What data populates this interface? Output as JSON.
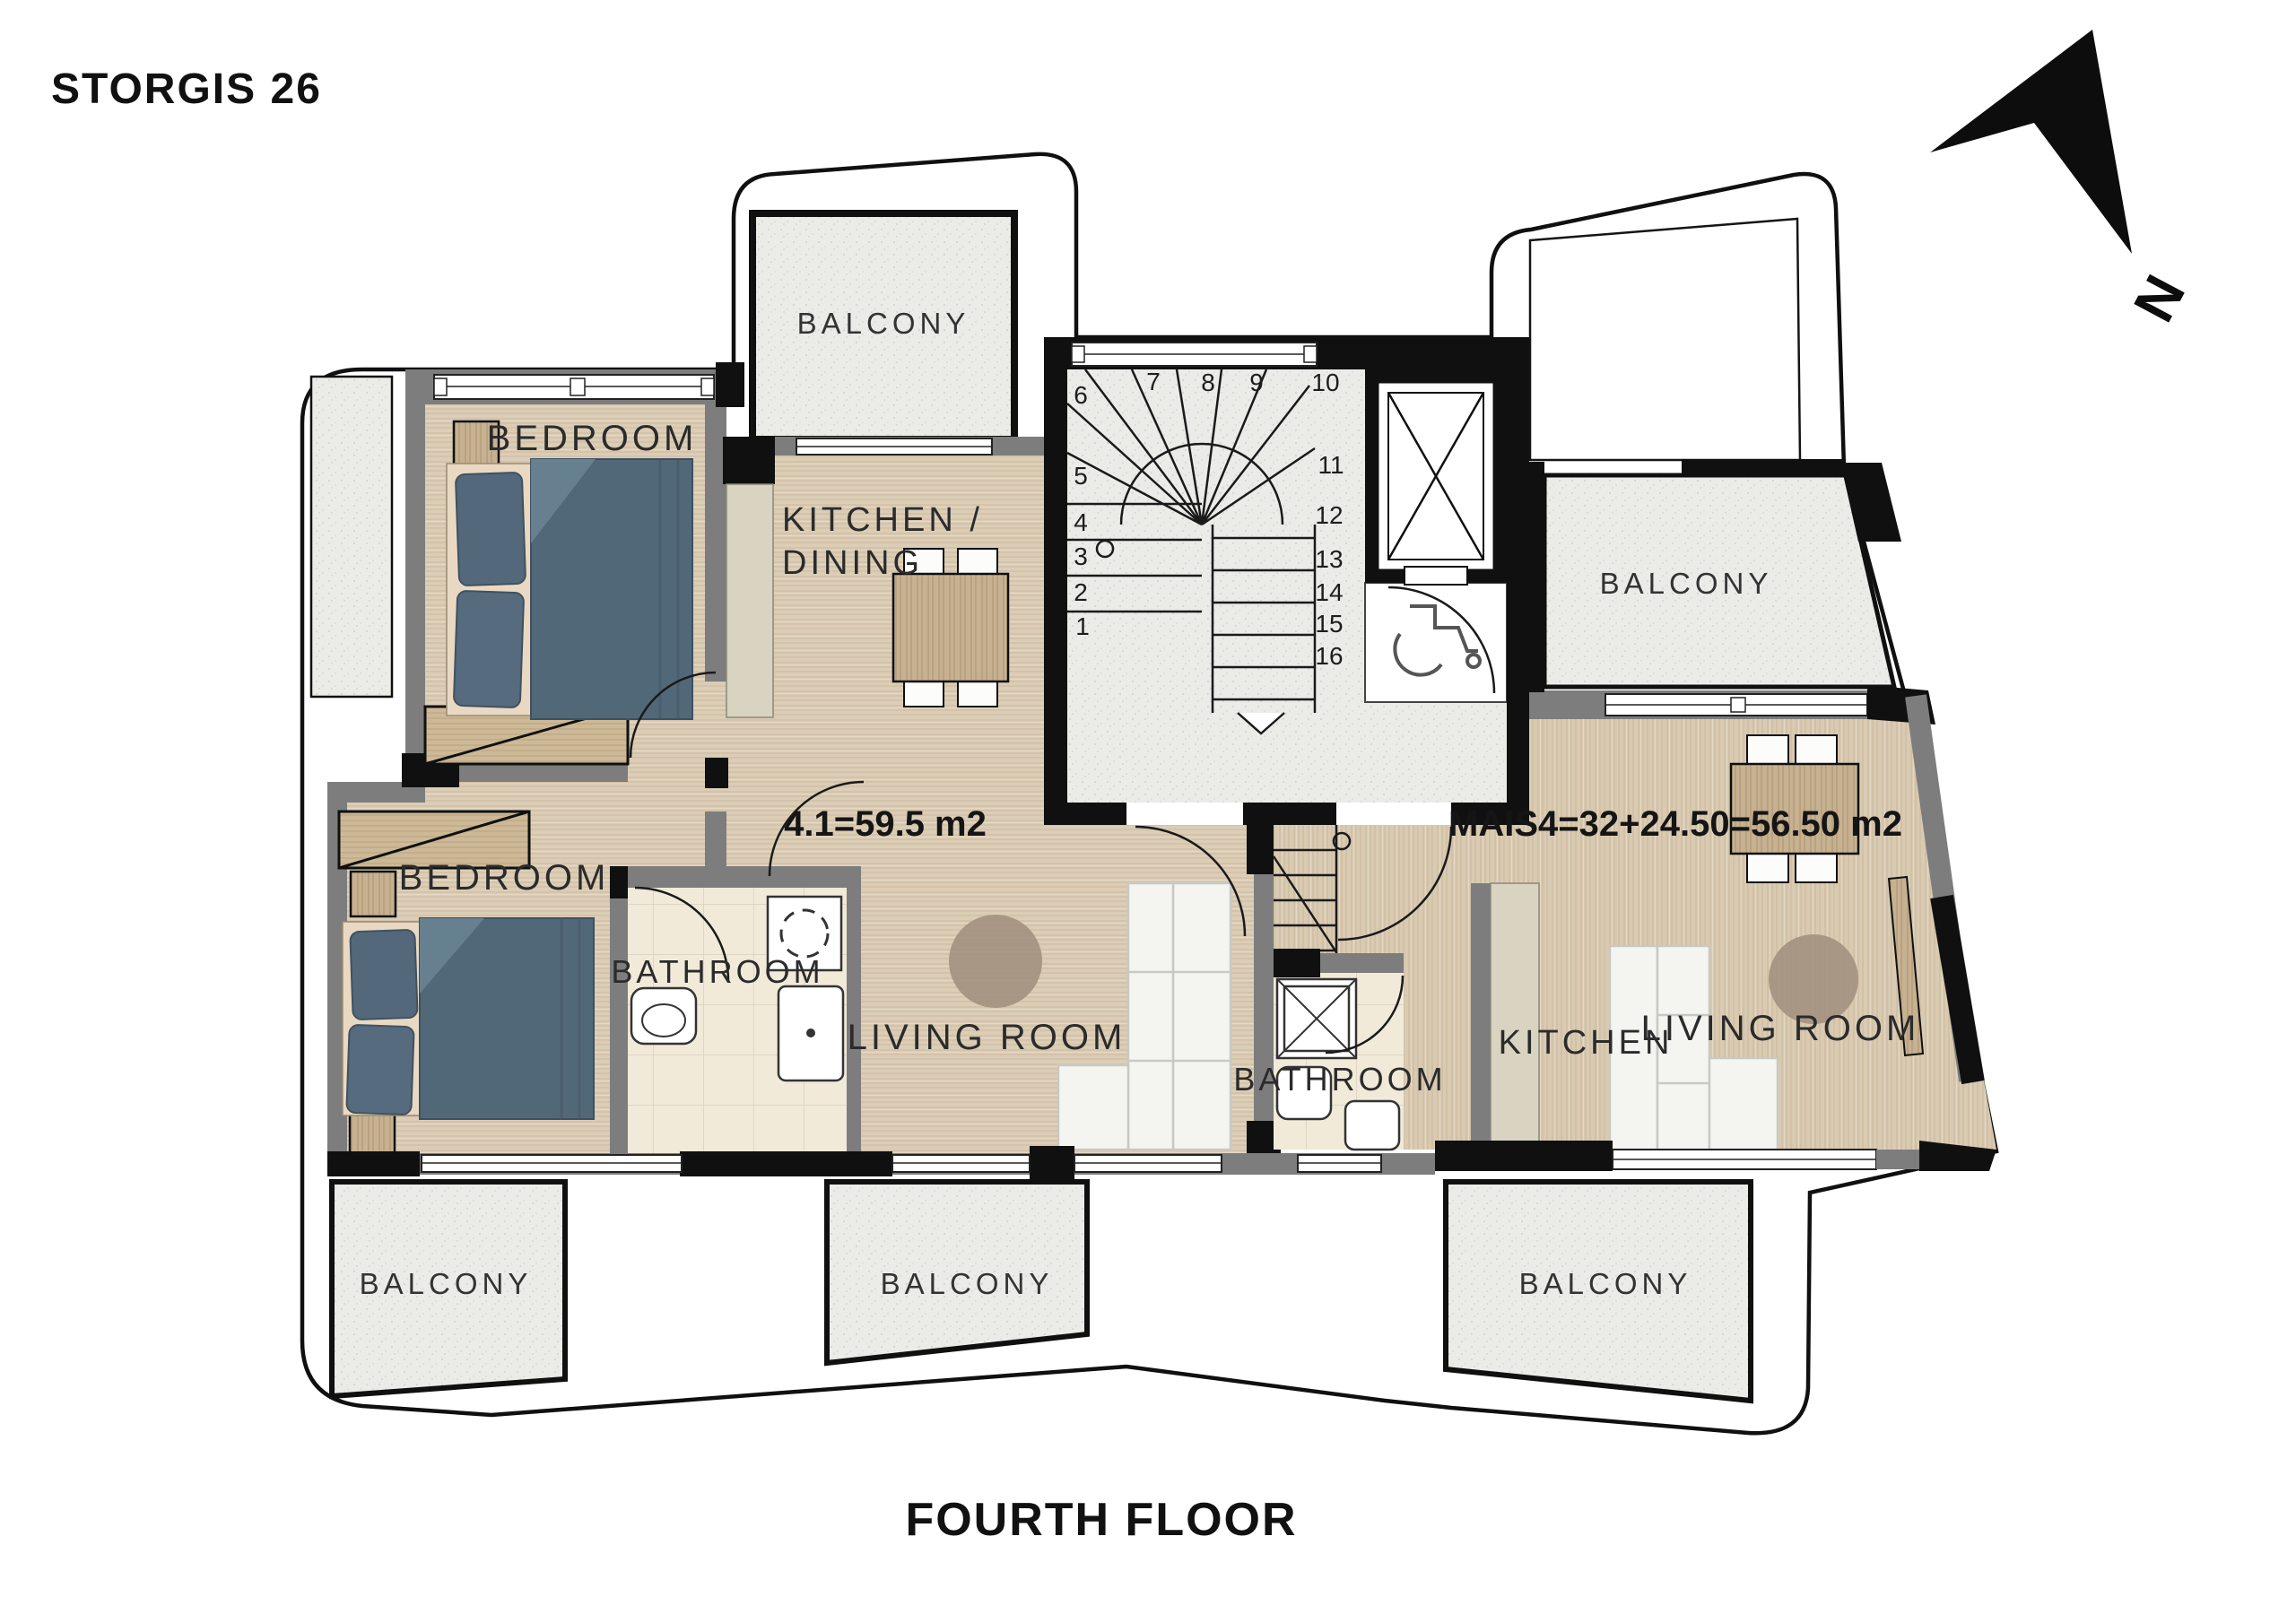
{
  "header": {
    "project_title": "STORGIS 26"
  },
  "footer": {
    "floor_label": "FOURTH FLOOR"
  },
  "compass": {
    "north_label": "N"
  },
  "apartments": {
    "left": {
      "area_label": "4.1=59.5 m2",
      "bedroom1_label": "BEDROOM",
      "bedroom2_label": "BEDROOM",
      "kitchen_dining_line1": "KITCHEN /",
      "kitchen_dining_line2": "DINING",
      "bathroom_label": "BATHROOM",
      "living_room_label": "LIVING ROOM"
    },
    "right": {
      "area_label": "MAIS4=32+24.50=56.50 m2",
      "kitchen_label": "KITCHEN",
      "living_room_label": "LIVING ROOM",
      "bathroom_label": "BATHROOM"
    }
  },
  "balconies": {
    "top_left": "BALCONY",
    "top_right": "BALCONY",
    "bottom_left": "BALCONY",
    "bottom_center": "BALCONY",
    "bottom_right": "BALCONY"
  },
  "staircase": {
    "steps": [
      "1",
      "2",
      "3",
      "4",
      "5",
      "6",
      "7",
      "8",
      "9",
      "10",
      "11",
      "12",
      "13",
      "14",
      "15",
      "16"
    ]
  },
  "palette": {
    "wall_black": "#101010",
    "wall_gray": "#7d7d7d",
    "wood_floor": "#dbcdb6",
    "furniture_wood": "#c6b191",
    "balcony_gray": "#ebebe8",
    "bathroom_tile": "#f1ead9",
    "counter_beige": "#d8d4c1",
    "bed_textile": "#53687a",
    "sofa_white": "#f4f4f1",
    "rug_brown": "#a3917f"
  }
}
